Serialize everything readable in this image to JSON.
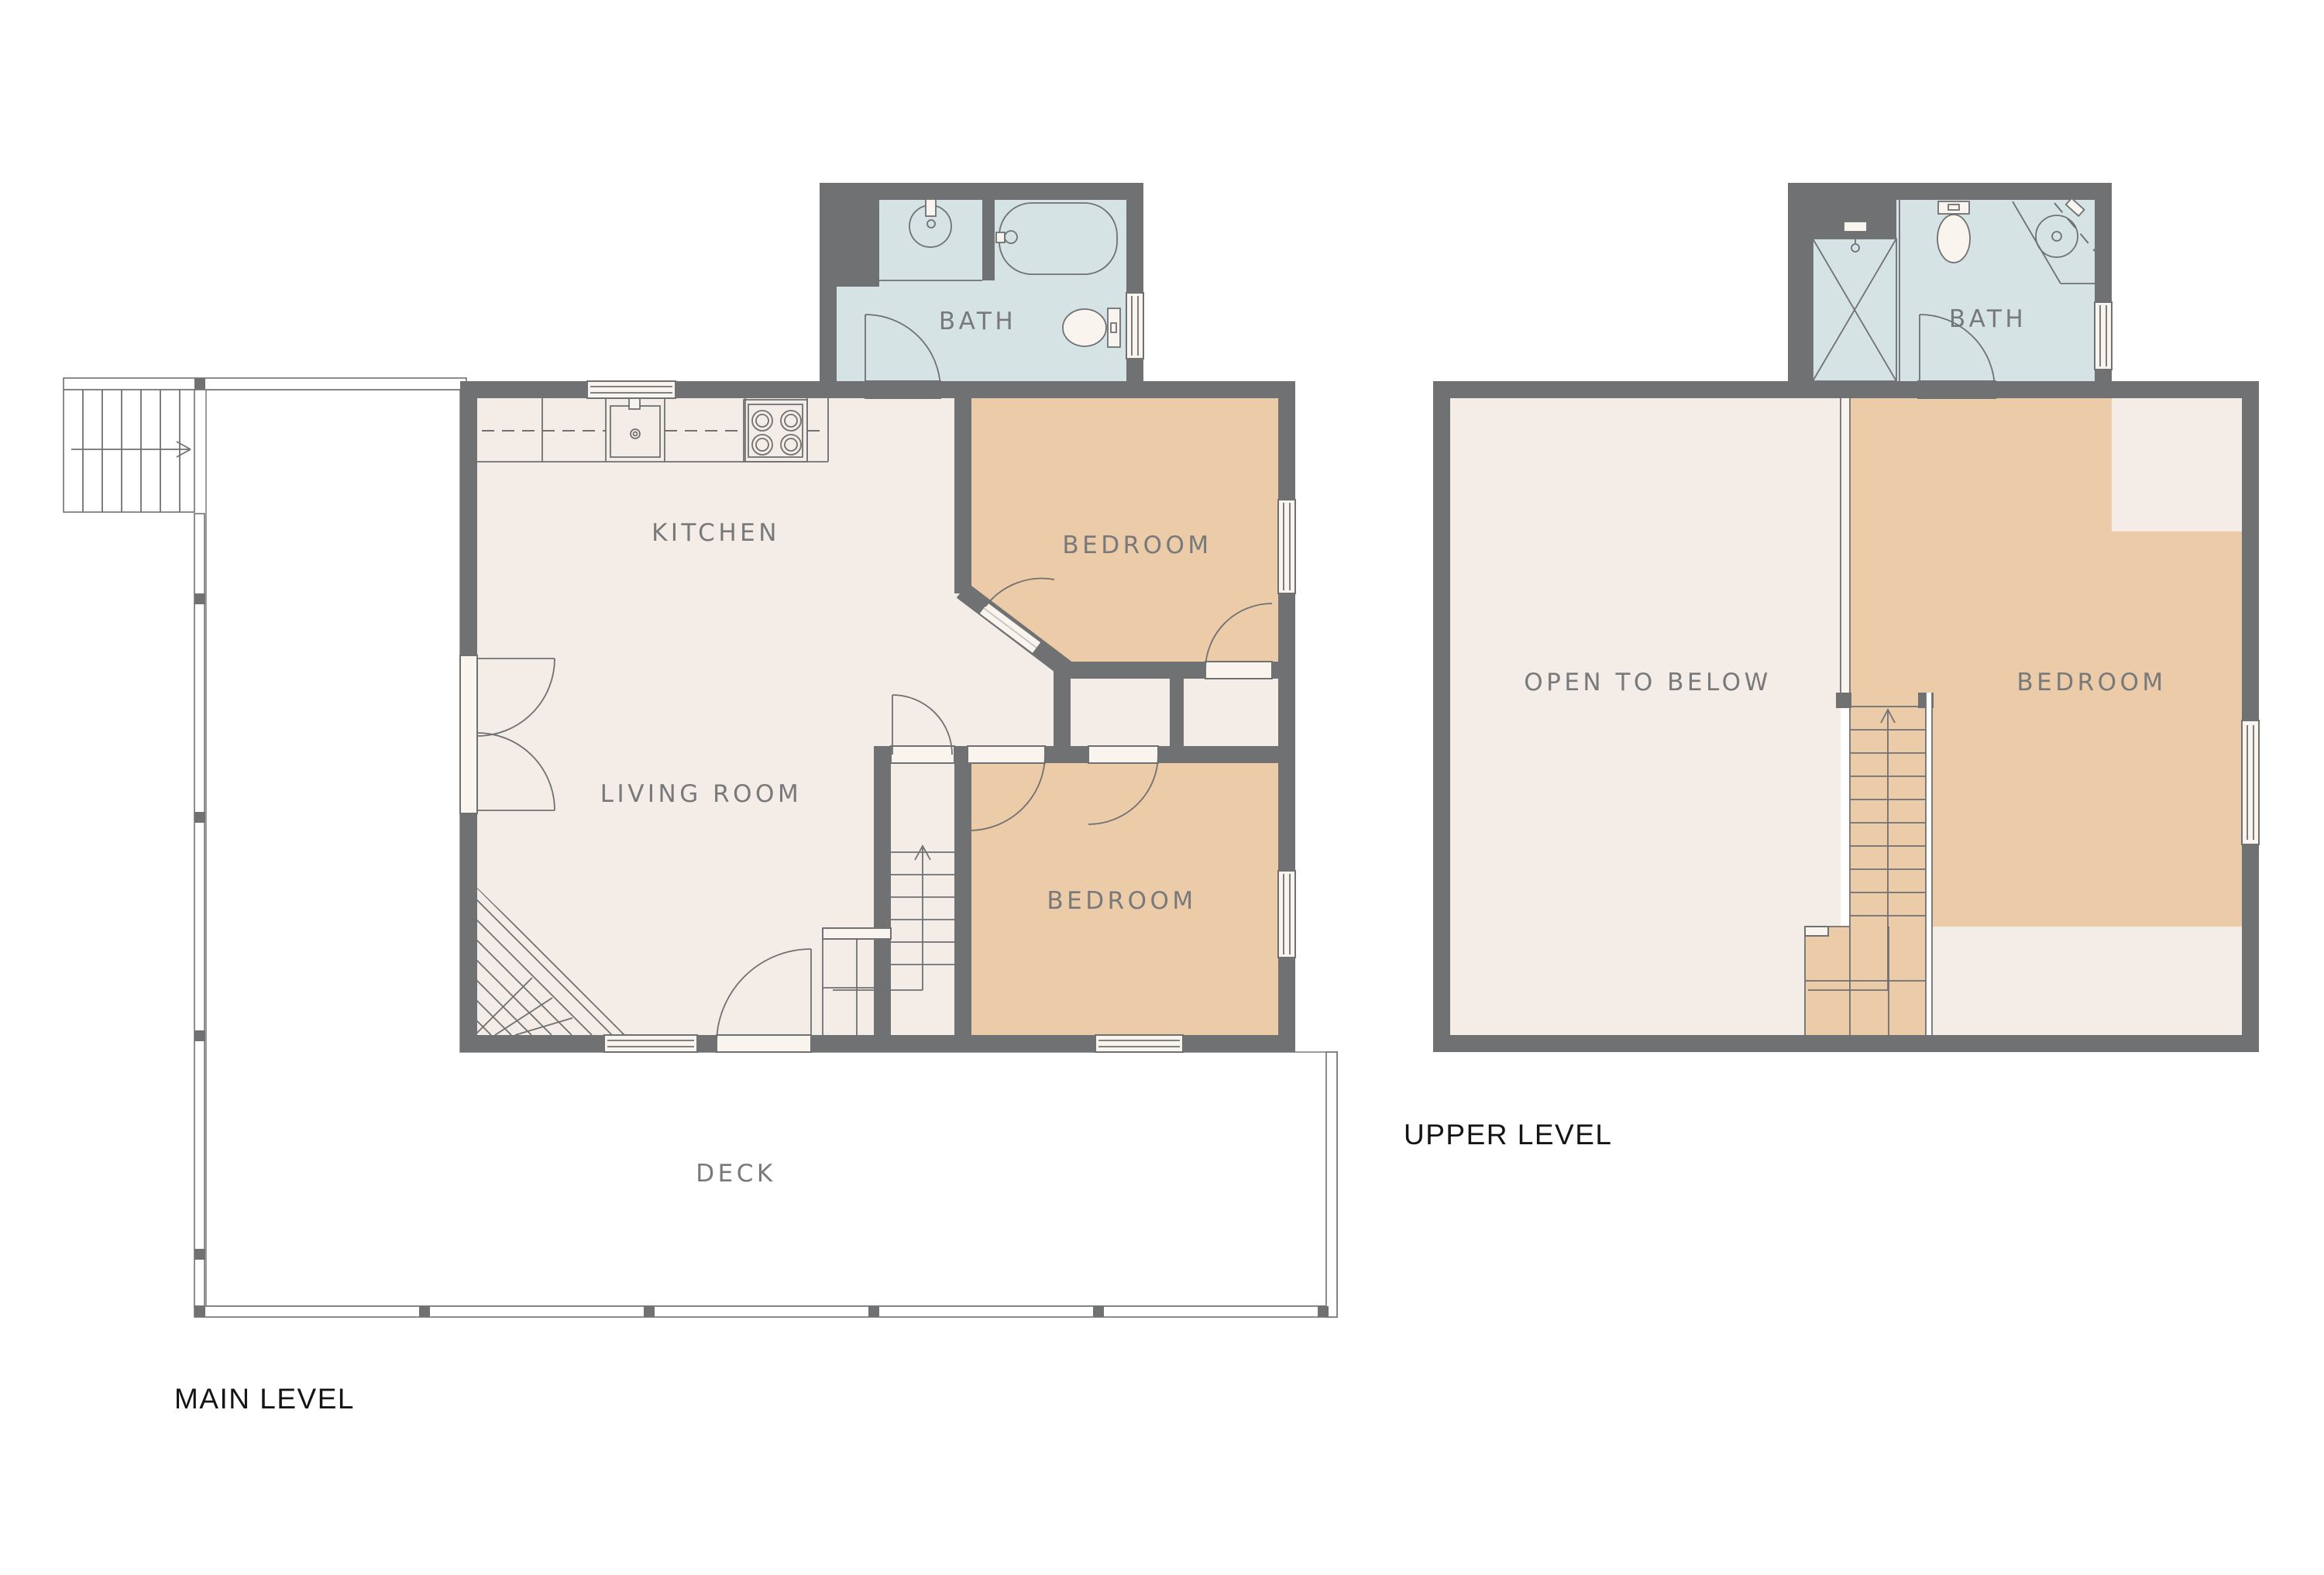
{
  "palette": {
    "wall": "#6F7173",
    "floor": "#F4ECE6",
    "bedroom": "#ECCBA8",
    "bath": "#D6E3E5",
    "deck": "#EBECED",
    "line": "#6F7173",
    "label": "#77797B",
    "title": "#141414",
    "threshold": "#FAF4EE"
  },
  "main_level": {
    "title": "MAIN LEVEL",
    "rooms": {
      "kitchen": "KITCHEN",
      "living_room": "LIVING ROOM",
      "bedroom_top": "BEDROOM",
      "bedroom_bottom": "BEDROOM",
      "bath": "BATH",
      "deck": "DECK"
    }
  },
  "upper_level": {
    "title": "UPPER LEVEL",
    "rooms": {
      "open_to_below": "OPEN TO BELOW",
      "bedroom": "BEDROOM",
      "bath": "BATH"
    }
  }
}
